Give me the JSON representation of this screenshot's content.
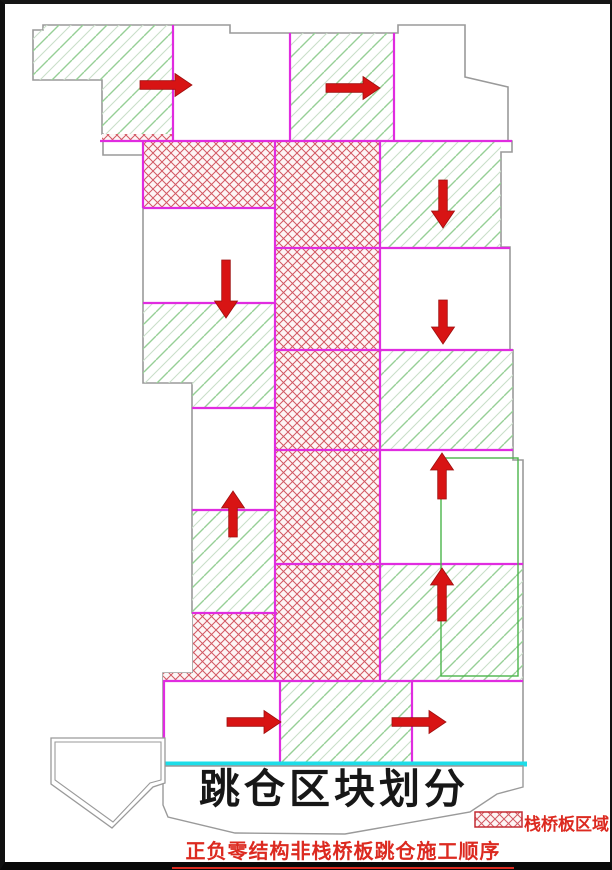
{
  "title": {
    "text": "跳仓区块划分"
  },
  "caption": {
    "text": "正负零结构非栈桥板跳仓施工顺序"
  },
  "legend": {
    "label": "栈桥板区域",
    "swatch": "red-crosshatch"
  },
  "colors": {
    "magenta_divider": "#e02ce0",
    "outline_gray": "#9a9a9a",
    "hatch_green": "#96cf96",
    "hatch_green_light": "#c9dfc9",
    "crosshatch_red": "#d25862",
    "crosshatch_bg": "#fdf5f5",
    "arrow_red": "#d81414",
    "arrow_edge": "#9e0f0f",
    "cyan_line": "#1ddde8",
    "inner_green": "#4bb54b",
    "title_black": "#171717",
    "red_text": "#dc2a20",
    "legend_border": "#c32c34"
  },
  "blocks": [
    {
      "id": "top-left",
      "fill": "green",
      "pts": [
        [
          43,
          25
        ],
        [
          173,
          25
        ],
        [
          173,
          134
        ],
        [
          102,
          134
        ],
        [
          102,
          80
        ],
        [
          33,
          80
        ],
        [
          33,
          30
        ],
        [
          43,
          30
        ]
      ]
    },
    {
      "id": "top-left-strip",
      "fill": "cross",
      "pts": [
        [
          102,
          134
        ],
        [
          173,
          134
        ],
        [
          173,
          141
        ],
        [
          102,
          141
        ]
      ]
    },
    {
      "id": "top-middle",
      "fill": "green",
      "pts": [
        [
          290,
          33
        ],
        [
          394,
          33
        ],
        [
          394,
          141
        ],
        [
          290,
          141
        ]
      ]
    },
    {
      "id": "left-row1",
      "fill": "cross",
      "pts": [
        [
          143,
          141
        ],
        [
          275,
          141
        ],
        [
          275,
          208
        ],
        [
          143,
          208
        ]
      ]
    },
    {
      "id": "center-column",
      "fill": "cross",
      "pts": [
        [
          275,
          141
        ],
        [
          380,
          141
        ],
        [
          380,
          681
        ],
        [
          275,
          681
        ]
      ]
    },
    {
      "id": "left-row3",
      "fill": "green",
      "pts": [
        [
          143,
          303
        ],
        [
          275,
          303
        ],
        [
          275,
          408
        ],
        [
          192,
          408
        ],
        [
          192,
          383
        ],
        [
          143,
          383
        ]
      ]
    },
    {
      "id": "left-row5",
      "fill": "green",
      "pts": [
        [
          192,
          510
        ],
        [
          275,
          510
        ],
        [
          275,
          613
        ],
        [
          192,
          613
        ]
      ]
    },
    {
      "id": "left-row6",
      "fill": "cross",
      "pts": [
        [
          193,
          613
        ],
        [
          277,
          613
        ],
        [
          277,
          681
        ],
        [
          163,
          681
        ],
        [
          163,
          673
        ],
        [
          193,
          673
        ]
      ]
    },
    {
      "id": "right-row1",
      "fill": "green",
      "pts": [
        [
          380,
          141
        ],
        [
          501,
          141
        ],
        [
          501,
          247
        ],
        [
          380,
          247
        ]
      ]
    },
    {
      "id": "right-row3",
      "fill": "green",
      "pts": [
        [
          380,
          350
        ],
        [
          513,
          350
        ],
        [
          513,
          449
        ],
        [
          380,
          449
        ]
      ]
    },
    {
      "id": "right-row5",
      "fill": "green",
      "pts": [
        [
          380,
          564
        ],
        [
          523,
          564
        ],
        [
          523,
          681
        ],
        [
          380,
          681
        ]
      ]
    },
    {
      "id": "bottom-middle",
      "fill": "green",
      "pts": [
        [
          280,
          681
        ],
        [
          412,
          681
        ],
        [
          412,
          763
        ],
        [
          280,
          763
        ]
      ]
    }
  ],
  "dividers": [
    [
      100,
      141,
      512,
      141
    ],
    [
      143,
      208,
      275,
      208
    ],
    [
      275,
      248,
      510,
      248
    ],
    [
      143,
      303,
      275,
      303
    ],
    [
      275,
      350,
      513,
      350
    ],
    [
      192,
      408,
      275,
      408
    ],
    [
      275,
      450,
      513,
      450
    ],
    [
      192,
      510,
      275,
      510
    ],
    [
      275,
      564,
      523,
      564
    ],
    [
      192,
      613,
      277,
      613
    ],
    [
      163,
      681,
      523,
      681
    ],
    [
      173,
      25,
      173,
      141
    ],
    [
      290,
      33,
      290,
      141
    ],
    [
      394,
      33,
      394,
      141
    ],
    [
      143,
      141,
      143,
      208
    ],
    [
      275,
      141,
      275,
      681
    ],
    [
      380,
      141,
      380,
      681
    ],
    [
      164,
      681,
      164,
      763
    ],
    [
      280,
      681,
      280,
      763
    ],
    [
      412,
      681,
      412,
      763
    ]
  ],
  "arrows": [
    {
      "dir": "right",
      "x1": 140,
      "y1": 85,
      "x2": 192,
      "y2": 85
    },
    {
      "dir": "right",
      "x1": 326,
      "y1": 88,
      "x2": 380,
      "y2": 88
    },
    {
      "dir": "down",
      "x1": 443,
      "y1": 180,
      "x2": 443,
      "y2": 228
    },
    {
      "dir": "down",
      "x1": 226,
      "y1": 260,
      "x2": 226,
      "y2": 318
    },
    {
      "dir": "down",
      "x1": 443,
      "y1": 300,
      "x2": 443,
      "y2": 344
    },
    {
      "dir": "up",
      "x1": 233,
      "y1": 537,
      "x2": 233,
      "y2": 491
    },
    {
      "dir": "up",
      "x1": 442,
      "y1": 499,
      "x2": 442,
      "y2": 453
    },
    {
      "dir": "up",
      "x1": 442,
      "y1": 621,
      "x2": 442,
      "y2": 568
    },
    {
      "dir": "right",
      "x1": 227,
      "y1": 722,
      "x2": 281,
      "y2": 722
    },
    {
      "dir": "right",
      "x1": 392,
      "y1": 722,
      "x2": 446,
      "y2": 722
    }
  ],
  "cyan_baseline": {
    "x1": 163,
    "y1": 764,
    "x2": 527,
    "y2": 764
  },
  "inner_green_rect": {
    "x": 441,
    "y": 458,
    "w": 77,
    "h": 218
  }
}
